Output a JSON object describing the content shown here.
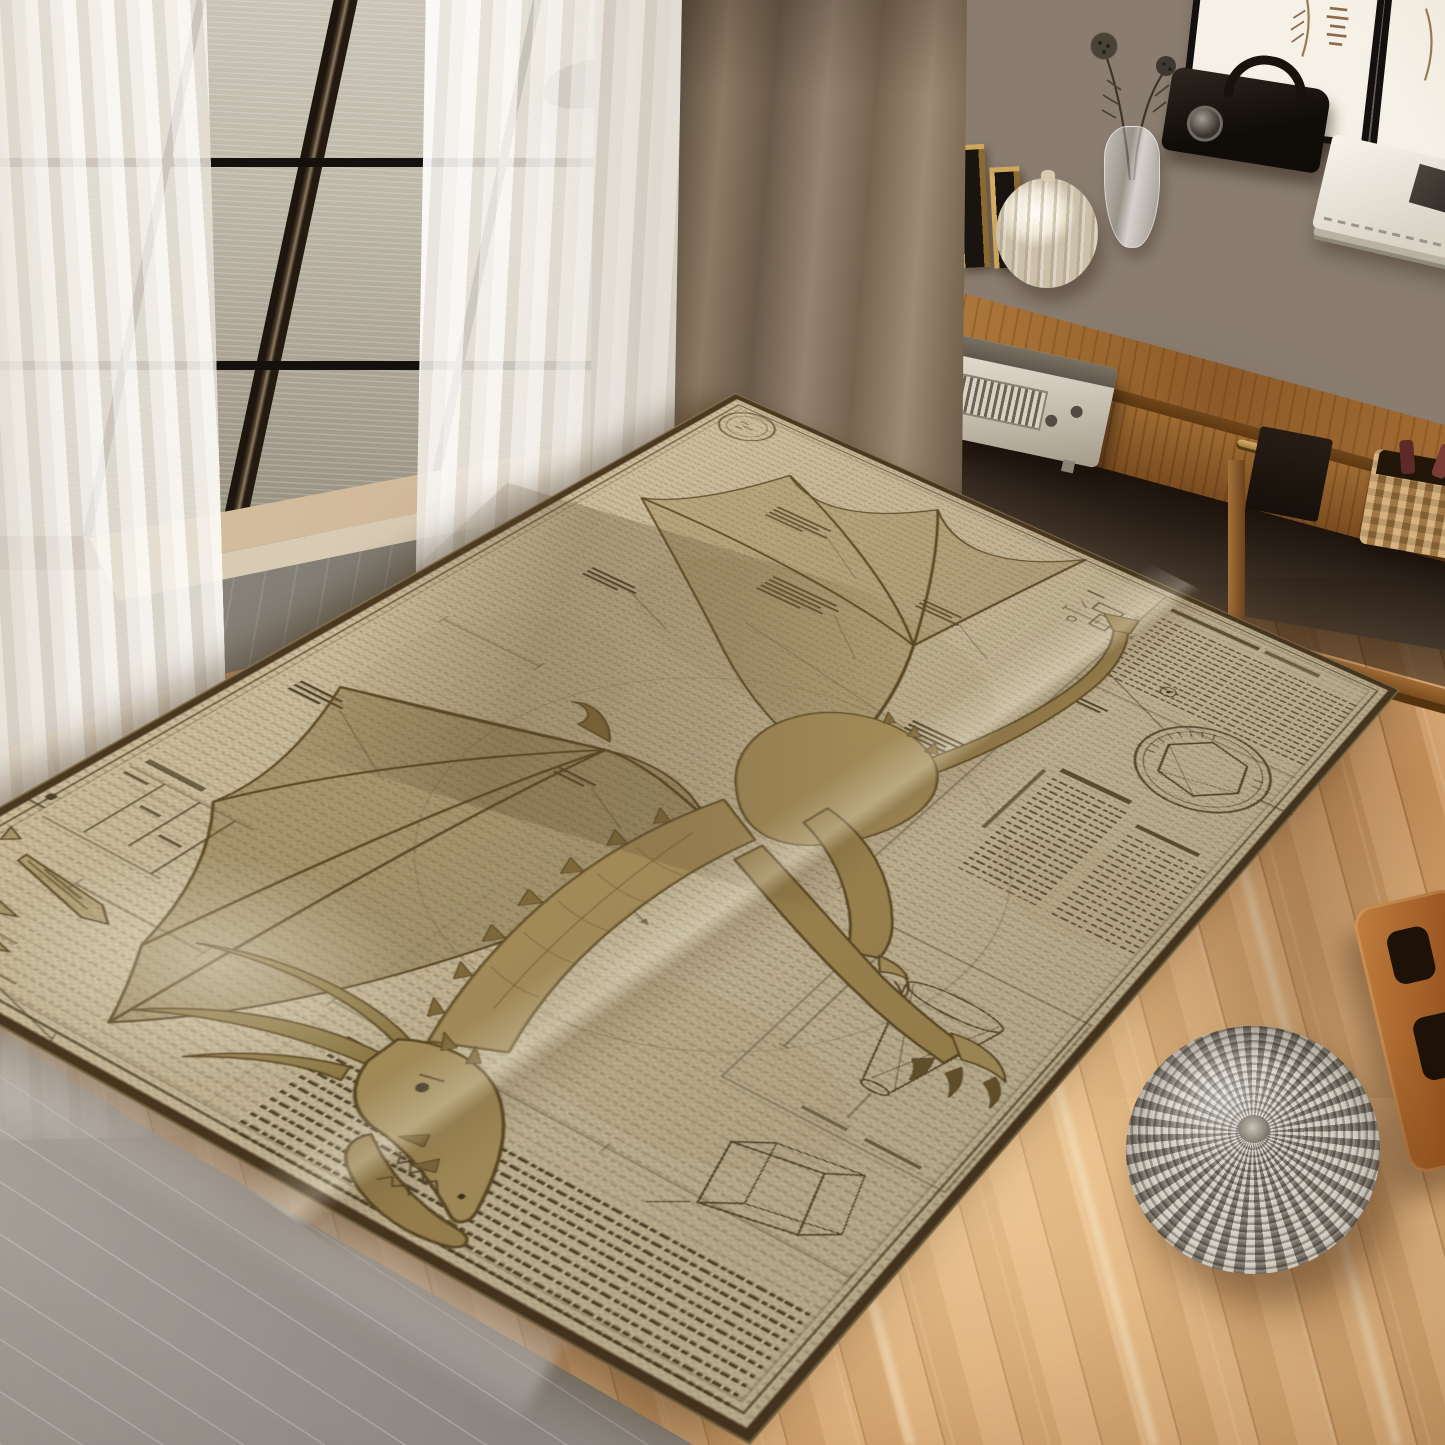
{
  "meta": {
    "title": "Sunlit living room with a da Vinci style dragon blueprint area rug"
  },
  "palette": {
    "wall": "#877969",
    "window_frame": "#46382a",
    "water": "#bcb6a7",
    "sheer_curtain": "#f4f1ea",
    "drape_curtain": "#7c6a55",
    "console_wood": "#9a6733",
    "floor_wood": "#dcaa72",
    "rug_parchment": "#d7caa8",
    "rug_ink": "#4c3f27",
    "rug_sepia": "#8a7340",
    "marble": "#9b958e",
    "pouf": "#b6afa3"
  },
  "window": {
    "label": "dark-framed paned window with calm sea view",
    "pane_columns": 3,
    "pane_rows": 3,
    "view": "rippled water with a dark rock"
  },
  "curtains": {
    "sheer_label": "white sheer curtain panels",
    "drape_label": "brown linen drape panel"
  },
  "wall_art": {
    "label": "framed botanical sketch prints",
    "frame_count": 2
  },
  "console": {
    "label": "wooden console table with two drawers and lower shelf",
    "drawer_count": 2,
    "top_decor": [
      "stepped gold and black candle blocks",
      "white ribbed gourd vase",
      "glass vase with dried seed pods",
      "black vintage camera with handle",
      "stack of cream books"
    ],
    "shelf_items": [
      "silver vintage radio",
      "dark keepsake box",
      "wicker basket with red handles"
    ]
  },
  "rug": {
    "label": "da Vinci blueprint style dragon area rug on parchment ground",
    "motif": "winged dragon schematic in sepia ink",
    "features": [
      "wax seal stamp",
      "hexagonal compass emblem",
      "wing membrane studies",
      "claw and spike studies",
      "funnel wireframe diagram",
      "prism wireframe diagram",
      "columns of aged script",
      "dimension and leader lines",
      "double inked border"
    ]
  },
  "floor": {
    "label": "light oak plank floor with sun streaks"
  },
  "foreground": {
    "pouf_label": "grey knitted round pouf",
    "marble_label": "polished stone slab corner",
    "side_label": "wooden magazine stand"
  }
}
